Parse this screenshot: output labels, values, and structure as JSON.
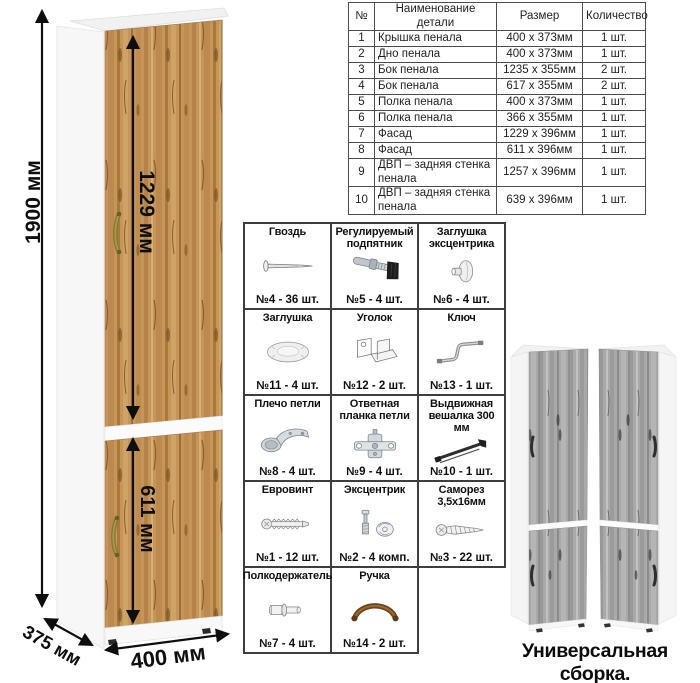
{
  "colors": {
    "wood": "#c6955a",
    "wood_dark": "#8a5f2e",
    "gray_wood": "#a9a9a9",
    "dimension_text": "#0e0e0e",
    "table_border": "#4c4c4c",
    "grid_border": "#3d3d3d",
    "handle_bronze": "#877a36"
  },
  "dimensions": {
    "height_label": "1900 мм",
    "upper_door_label": "1229 мм",
    "lower_door_label": "611 мм",
    "width_label": "400 мм",
    "depth_label": "375 мм"
  },
  "parts_table": {
    "headers": [
      "№",
      "Наименование детали",
      "Размер",
      "Количество"
    ],
    "rows": [
      [
        "1",
        "Крышка пенала",
        "400 х 373мм",
        "1 шт."
      ],
      [
        "2",
        "Дно пенала",
        "400 х 373мм",
        "1 шт."
      ],
      [
        "3",
        "Бок пенала",
        "1235 х 355мм",
        "2 шт."
      ],
      [
        "4",
        "Бок пенала",
        "617 х 355мм",
        "2 шт."
      ],
      [
        "5",
        "Полка пенала",
        "400 х 373мм",
        "1 шт."
      ],
      [
        "6",
        "Полка пенала",
        "366 х 355мм",
        "1 шт."
      ],
      [
        "7",
        "Фасад",
        "1229 х 396мм",
        "1 шт."
      ],
      [
        "8",
        "Фасад",
        "611 х 396мм",
        "1 шт."
      ],
      [
        "9",
        "ДВП – задняя стенка пенала",
        "1257 х 396мм",
        "1 шт."
      ],
      [
        "10",
        "ДВП – задняя стенка пенала",
        "639 х 396мм",
        "1 шт."
      ]
    ]
  },
  "hardware": {
    "items": [
      {
        "title": "Гвоздь",
        "count": "№4 - 36 шт.",
        "icon": "nail-icon"
      },
      {
        "title": "Регулируемый подпятник",
        "count": "№5 - 4 шт.",
        "icon": "adjustable-foot-icon"
      },
      {
        "title": "Заглушка эксцентрика",
        "count": "№6 - 4 шт.",
        "icon": "cam-cap-icon"
      },
      {
        "title": "Заглушка",
        "count": "№11 - 4 шт.",
        "icon": "cap-icon"
      },
      {
        "title": "Уголок",
        "count": "№12 - 2 шт.",
        "icon": "corner-bracket-icon"
      },
      {
        "title": "Ключ",
        "count": "№13 - 1 шт.",
        "icon": "cam-key-icon"
      },
      {
        "title": "Плечо петли",
        "count": "№8 - 4 шт.",
        "icon": "hinge-arm-icon"
      },
      {
        "title": "Ответная планка петли",
        "count": "№9 - 4 шт.",
        "icon": "hinge-plate-icon"
      },
      {
        "title": "Выдвижная вешалка 300 мм",
        "count": "№10 - 1 шт.",
        "icon": "pullout-hanger-icon"
      },
      {
        "title": "Евровинт",
        "count": "№1 - 12 шт.",
        "icon": "confirmat-screw-icon"
      },
      {
        "title": "Эксцентрик",
        "count": "№2 - 4 комп.",
        "icon": "cam-lock-icon"
      },
      {
        "title": "Саморез 3,5х16мм",
        "count": "№3 - 22 шт.",
        "icon": "screw-icon"
      },
      {
        "title": "Полкодержатель",
        "count": "№7 - 4 шт.",
        "icon": "shelf-pin-icon"
      },
      {
        "title": "Ручка",
        "count": "№14 - 2 шт.",
        "icon": "handle-icon"
      }
    ]
  },
  "footer": {
    "caption": "Универсальная сборка."
  }
}
